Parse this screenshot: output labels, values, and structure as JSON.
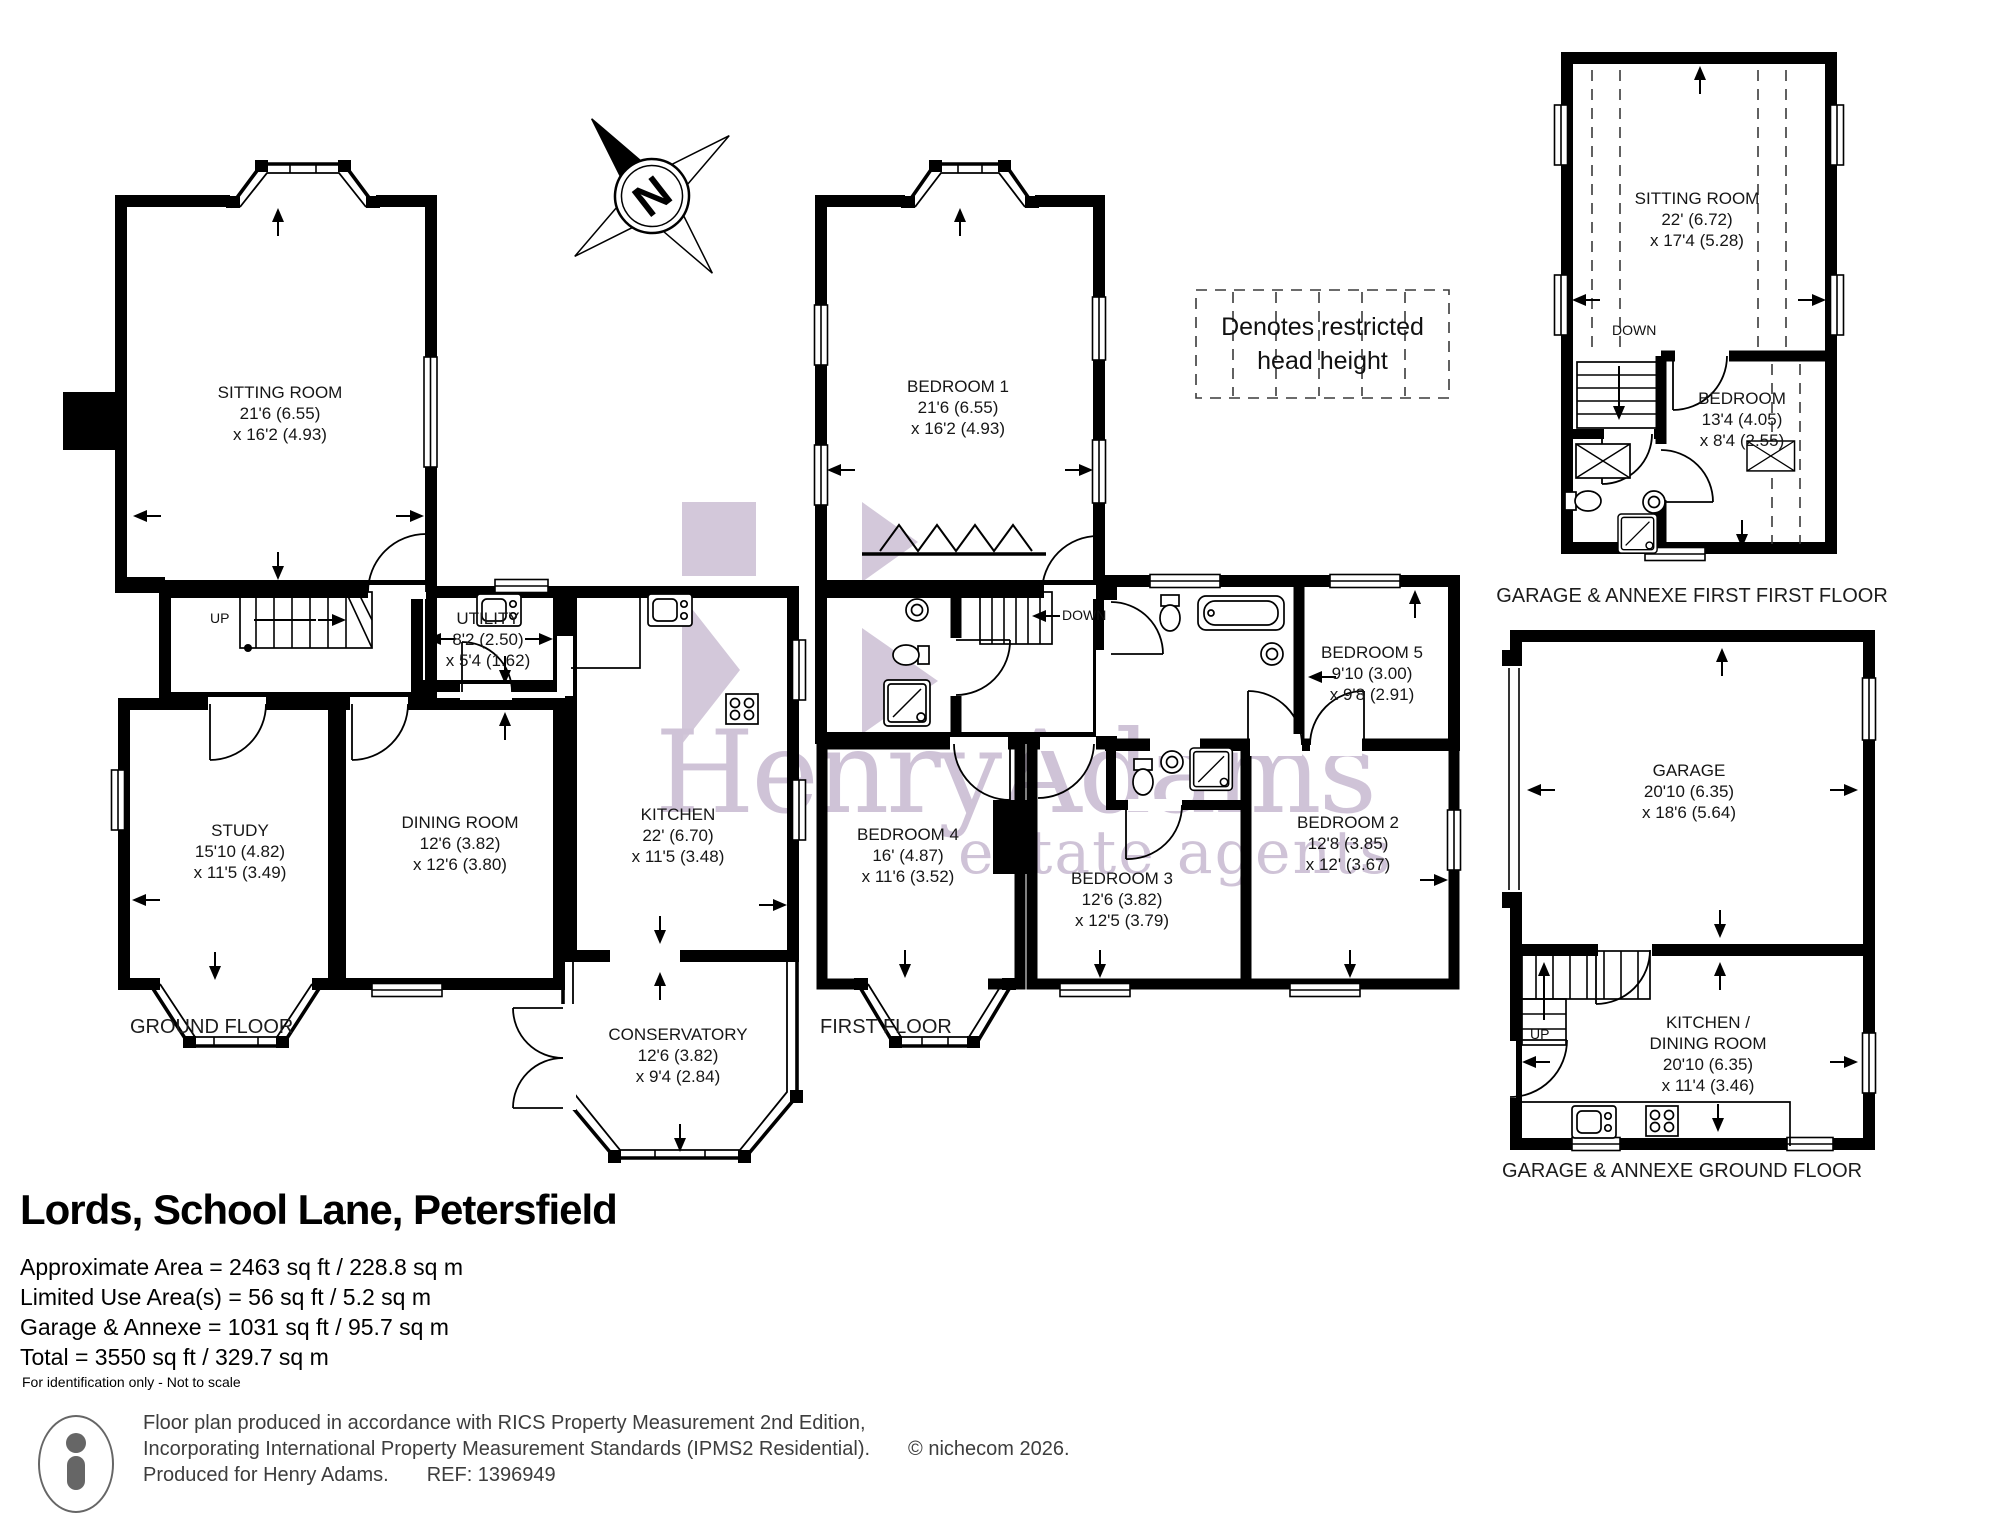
{
  "property": {
    "title": "Lords, School Lane, Petersfield",
    "areas": [
      "Approximate Area = 2463 sq ft / 228.8 sq m",
      "Limited Use Area(s) = 56 sq ft / 5.2 sq m",
      "Garage & Annexe = 1031 sq ft / 95.7 sq m",
      "Total = 3550 sq ft / 329.7 sq m"
    ],
    "disclaimer": "For identification only - Not to scale"
  },
  "floors": {
    "ground": {
      "label": "GROUND FLOOR",
      "stairs": "UP",
      "rooms": {
        "sitting": {
          "name": "SITTING ROOM",
          "d1": "21'6 (6.55)",
          "d2": "x 16'2 (4.93)"
        },
        "utility": {
          "name": "UTILITY",
          "d1": "8'2 (2.50)",
          "d2": "x 5'4 (1.62)"
        },
        "study": {
          "name": "STUDY",
          "d1": "15'10 (4.82)",
          "d2": "x 11'5 (3.49)"
        },
        "dining": {
          "name": "DINING ROOM",
          "d1": "12'6 (3.82)",
          "d2": "x 12'6 (3.80)"
        },
        "kitchen": {
          "name": "KITCHEN",
          "d1": "22' (6.70)",
          "d2": "x 11'5 (3.48)"
        },
        "conservatory": {
          "name": "CONSERVATORY",
          "d1": "12'6 (3.82)",
          "d2": "x 9'4 (2.84)"
        }
      }
    },
    "first": {
      "label": "FIRST FLOOR",
      "stairs": "DOWN",
      "rooms": {
        "bed1": {
          "name": "BEDROOM 1",
          "d1": "21'6 (6.55)",
          "d2": "x 16'2 (4.93)"
        },
        "bed2": {
          "name": "BEDROOM 2",
          "d1": "12'8 (3.85)",
          "d2": "x 12' (3.67)"
        },
        "bed3": {
          "name": "BEDROOM 3",
          "d1": "12'6 (3.82)",
          "d2": "x 12'5 (3.79)"
        },
        "bed4": {
          "name": "BEDROOM 4",
          "d1": "16' (4.87)",
          "d2": "x 11'6 (3.52)"
        },
        "bed5": {
          "name": "BEDROOM 5",
          "d1": "9'10 (3.00)",
          "d2": "x 9'8 (2.91)"
        }
      }
    },
    "annexe_first": {
      "label": "GARAGE & ANNEXE FIRST FIRST FLOOR",
      "stairs": "DOWN",
      "rooms": {
        "sitting": {
          "name": "SITTING ROOM",
          "d1": "22' (6.72)",
          "d2": "x 17'4 (5.28)"
        },
        "bedroom": {
          "name": "BEDROOM",
          "d1": "13'4 (4.05)",
          "d2": "x 8'4 (2.55)"
        }
      }
    },
    "annexe_ground": {
      "label": "GARAGE & ANNEXE GROUND FLOOR",
      "stairs": "UP",
      "rooms": {
        "garage": {
          "name": "GARAGE",
          "d1": "20'10 (6.35)",
          "d2": "x 18'6 (5.64)"
        },
        "kitchen_dining": {
          "name": "KITCHEN /",
          "name2": "DINING ROOM",
          "d1": "20'10 (6.35)",
          "d2": "x 11'4 (3.46)"
        }
      }
    }
  },
  "legend": {
    "line1": "Denotes restricted",
    "line2": "head height"
  },
  "compass": {
    "north": "N"
  },
  "watermark": {
    "brand": "HenryAdams",
    "tagline": "estate agents",
    "color": "#cfc3d7"
  },
  "footer": {
    "line1": "Floor plan produced in accordance with RICS Property Measurement 2nd Edition,",
    "line2": "Incorporating International Property Measurement Standards (IPMS2 Residential).",
    "copyright": "© nichecom 2026.",
    "line3": "Produced for Henry Adams.",
    "ref": "REF: 1396949"
  }
}
